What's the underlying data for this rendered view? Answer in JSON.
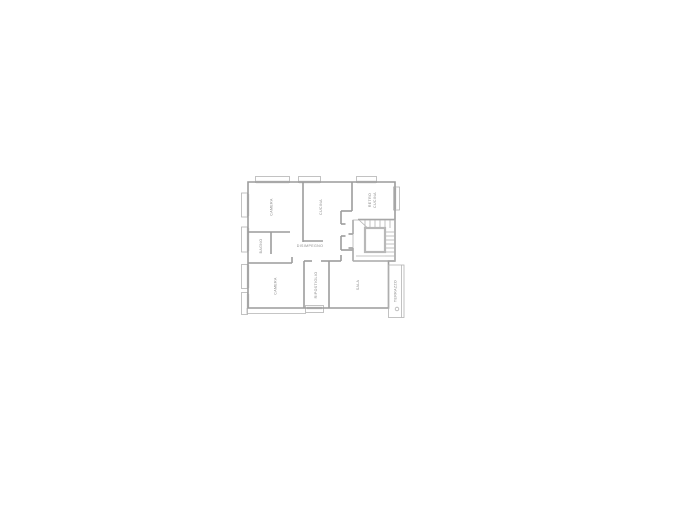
{
  "page": {
    "background_color": "#ffffff"
  },
  "floor_plan": {
    "colors": {
      "wall": "#9c9c9c",
      "thin_line": "#b3b3b3",
      "window_mark": "#cdcdcd",
      "label": "#8a8a8a"
    },
    "rooms": [
      {
        "id": "camera-top",
        "label": "CAMERA"
      },
      {
        "id": "cucina",
        "label": "CUCINA"
      },
      {
        "id": "retro-cucina",
        "label_line1": "RETRO",
        "label_line2": "CUCINA"
      },
      {
        "id": "bagno",
        "label": "BAGNO"
      },
      {
        "id": "disimpegno",
        "label": "DISIMPEGNO"
      },
      {
        "id": "camera-bottom",
        "label": "CAMERA"
      },
      {
        "id": "ripostiglio",
        "label": "RIPOSTIGLIO"
      },
      {
        "id": "sala",
        "label": "SALA"
      },
      {
        "id": "terrazzo",
        "label": "TERRAZZO"
      }
    ]
  }
}
